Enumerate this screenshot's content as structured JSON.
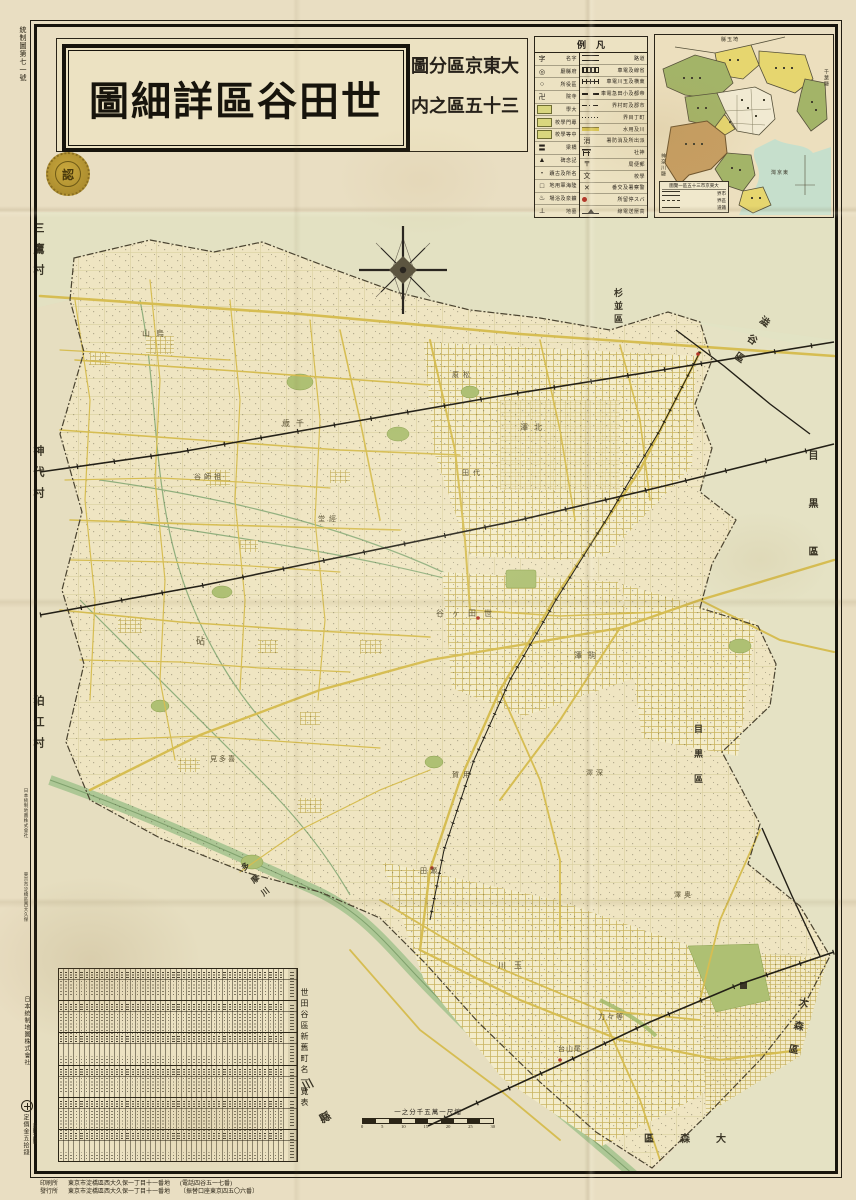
{
  "title": {
    "main": "世田谷區詳細圖",
    "series_line1": "大東京區分圖",
    "series_line2": "三十五區之内",
    "seal": "認"
  },
  "meta": {
    "registration_no": "統制圖第七一號",
    "publisher_vertical": "日本統制地圖株式會社",
    "price": "定價金五拾錢",
    "price_note": "〔送料六錢〕",
    "margin_snippets": [
      {
        "t": "日本統制地圖株式會社",
        "y": 788
      },
      {
        "t": "東京市淀橋區西大久保",
        "y": 872
      }
    ],
    "bottom_lines": [
      {
        "label": "印刷所",
        "addr": "東京市淀橋區西大久保一丁目十一番地",
        "extra": "(電話四谷五一七番)"
      },
      {
        "label": "發行所",
        "addr": "東京市淀橋區西大久保一丁目十一番地",
        "extra": "〔振替口座東京四五〇六番〕"
      }
    ]
  },
  "legend": {
    "title": "凡例",
    "left_rows": [
      {
        "label": "字名",
        "type": "glyph",
        "glyph": "字"
      },
      {
        "label": "府縣廳",
        "type": "glyph",
        "glyph": "◎"
      },
      {
        "label": "區役所",
        "type": "glyph",
        "glyph": "○"
      },
      {
        "label": "寺院",
        "type": "glyph",
        "glyph": "卍"
      },
      {
        "label": "大學",
        "type": "box"
      },
      {
        "label": "專門學校",
        "type": "box"
      },
      {
        "label": "中等學校",
        "type": "box"
      },
      {
        "label": "橋梁",
        "type": "glyph",
        "glyph": "〓"
      },
      {
        "label": "記念碑",
        "type": "glyph",
        "glyph": "▲"
      },
      {
        "label": "名所及古蹟",
        "type": "glyph",
        "glyph": "・"
      },
      {
        "label": "陸海軍用地",
        "type": "glyph",
        "glyph": "□"
      },
      {
        "label": "鑛泉及浴場",
        "type": "glyph",
        "glyph": "♨"
      },
      {
        "label": "墓地",
        "type": "glyph",
        "glyph": "⊥"
      }
    ],
    "right_rows": [
      {
        "label": "道路",
        "type": "double"
      },
      {
        "label": "省線及電車",
        "type": "rail"
      },
      {
        "label": "東横及玉川電車",
        "type": "tram"
      },
      {
        "label": "帝都及小田急電車",
        "type": "dashrail"
      },
      {
        "label": "市郡及町村界",
        "type": "dashdot"
      },
      {
        "label": "町丁目界",
        "type": "dot"
      },
      {
        "label": "川及用水",
        "type": "water"
      },
      {
        "label": "派出所及消防署",
        "type": "glyph",
        "glyph": "消"
      },
      {
        "label": "神社",
        "type": "torii"
      },
      {
        "label": "郵便局",
        "type": "glyph",
        "glyph": "〒"
      },
      {
        "label": "學校",
        "type": "glyph",
        "glyph": "文"
      },
      {
        "label": "警察署及交番",
        "type": "glyph",
        "glyph": "✕"
      },
      {
        "label": "バス停留所",
        "type": "dotred"
      },
      {
        "label": "高壓送電線",
        "type": "power"
      }
    ]
  },
  "inset": {
    "title": "大東京市三十五區一覽圖",
    "highlight": "世田谷區",
    "labels": [
      {
        "t": "埼玉縣",
        "x": 66,
        "y": 1,
        "v": 0
      },
      {
        "t": "千葉縣",
        "x": 167,
        "y": 34,
        "v": 1
      },
      {
        "t": "神奈川縣",
        "x": 4,
        "y": 118,
        "v": 1
      },
      {
        "t": "東京灣",
        "x": 116,
        "y": 134,
        "v": 0
      }
    ],
    "legend_rows": [
      {
        "t": "市界",
        "ln": "r"
      },
      {
        "t": "區界",
        "ln": "d"
      },
      {
        "t": "鐵道",
        "ln": "s"
      }
    ]
  },
  "scale": {
    "text": "縮尺一萬五千分之一",
    "ticks": [
      "0",
      "5",
      "10",
      "15",
      "20",
      "25",
      "30"
    ]
  },
  "table": {
    "title": "世田谷區新舊町名一覽表",
    "bands": 6,
    "columns": 44
  },
  "map": {
    "labels": [
      {
        "t": "三鷹村",
        "x": 30,
        "y": 222,
        "v": 1,
        "fs": 11,
        "ls": 10,
        "cls": "nb"
      },
      {
        "t": "神代村",
        "x": 30,
        "y": 445,
        "v": 1,
        "fs": 11,
        "ls": 10,
        "cls": "nb"
      },
      {
        "t": "狛江村",
        "x": 30,
        "y": 695,
        "v": 1,
        "fs": 11,
        "ls": 10,
        "cls": "nb"
      },
      {
        "t": "杉並區",
        "x": 612,
        "y": 288,
        "v": 1,
        "fs": 9,
        "ls": 4,
        "cls": "nb"
      },
      {
        "t": "澁谷區",
        "x": 740,
        "y": 310,
        "v": 1,
        "fs": 10,
        "ls": 12,
        "rot": 35,
        "cls": "nb"
      },
      {
        "t": "目黒區",
        "x": 804,
        "y": 450,
        "v": 1,
        "fs": 10,
        "ls": 38,
        "cls": "nb"
      },
      {
        "t": "目黒區",
        "x": 692,
        "y": 724,
        "v": 1,
        "fs": 9,
        "ls": 16,
        "cls": "nb"
      },
      {
        "t": "大森區",
        "x": 788,
        "y": 996,
        "v": 1,
        "fs": 10,
        "ls": 14,
        "rot": 12,
        "cls": "nb"
      },
      {
        "t": "大森區",
        "x": 644,
        "y": 1130,
        "v": 0,
        "fs": 10,
        "ls": 26,
        "cls": "nb"
      },
      {
        "t": "神奈川縣",
        "x": 296,
        "y": 1006,
        "v": 1,
        "fs": 11,
        "ls": 26,
        "rot": -28,
        "cls": "nb"
      },
      {
        "t": "多摩川",
        "x": 252,
        "y": 858,
        "v": 1,
        "fs": 8,
        "ls": 8,
        "rot": -38,
        "cls": "nb"
      },
      {
        "t": "烏山",
        "x": 142,
        "y": 328,
        "v": 0,
        "fs": 8,
        "ls": 6,
        "cls": "ar"
      },
      {
        "t": "祖師谷",
        "x": 194,
        "y": 472,
        "v": 0,
        "fs": 7,
        "ls": 3,
        "cls": "ar"
      },
      {
        "t": "千歳",
        "x": 282,
        "y": 418,
        "v": 0,
        "fs": 8,
        "ls": 6,
        "cls": "ar"
      },
      {
        "t": "經堂",
        "x": 318,
        "y": 514,
        "v": 0,
        "fs": 7,
        "ls": 4,
        "cls": "ar"
      },
      {
        "t": "松原",
        "x": 452,
        "y": 370,
        "v": 0,
        "fs": 7,
        "ls": 4,
        "cls": "ar"
      },
      {
        "t": "北澤",
        "x": 520,
        "y": 422,
        "v": 0,
        "fs": 8,
        "ls": 6,
        "cls": "ar"
      },
      {
        "t": "代田",
        "x": 462,
        "y": 468,
        "v": 0,
        "fs": 7,
        "ls": 4,
        "cls": "ar"
      },
      {
        "t": "世田ヶ谷",
        "x": 436,
        "y": 608,
        "v": 0,
        "fs": 8,
        "ls": 8,
        "cls": "ar"
      },
      {
        "t": "砧",
        "x": 196,
        "y": 634,
        "v": 0,
        "fs": 9,
        "ls": 0,
        "cls": "ar"
      },
      {
        "t": "喜多見",
        "x": 210,
        "y": 754,
        "v": 0,
        "fs": 7,
        "ls": 2,
        "cls": "ar"
      },
      {
        "t": "用賀",
        "x": 452,
        "y": 770,
        "v": 0,
        "fs": 7,
        "ls": 4,
        "cls": "ar"
      },
      {
        "t": "駒澤",
        "x": 574,
        "y": 650,
        "v": 0,
        "fs": 8,
        "ls": 6,
        "cls": "ar"
      },
      {
        "t": "深澤",
        "x": 586,
        "y": 768,
        "v": 0,
        "fs": 7,
        "ls": 3,
        "cls": "ar"
      },
      {
        "t": "瀬田",
        "x": 420,
        "y": 866,
        "v": 0,
        "fs": 7,
        "ls": 3,
        "cls": "ar"
      },
      {
        "t": "玉川",
        "x": 498,
        "y": 960,
        "v": 0,
        "fs": 8,
        "ls": 8,
        "cls": "ar"
      },
      {
        "t": "等々力",
        "x": 598,
        "y": 1012,
        "v": 0,
        "fs": 7,
        "ls": 2,
        "cls": "ar"
      },
      {
        "t": "奥澤",
        "x": 674,
        "y": 890,
        "v": 0,
        "fs": 7,
        "ls": 3,
        "cls": "ar"
      },
      {
        "t": "尾山台",
        "x": 558,
        "y": 1044,
        "v": 0,
        "fs": 7,
        "ls": 1,
        "cls": "ar"
      }
    ]
  },
  "colors": {
    "paper": "#e9dec2",
    "road_yellow": "#d6bd52",
    "park_green": "#aec073",
    "river_green": "#adc795",
    "rail_black": "#221f16",
    "highlight_tan": "#c79e62",
    "accent_red": "#b4372a"
  }
}
